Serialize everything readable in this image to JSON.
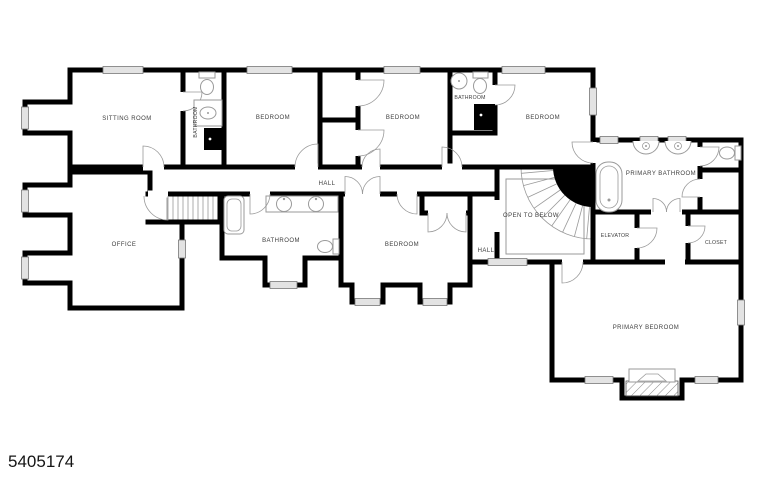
{
  "plan": {
    "id_label": "5405174",
    "type": "second-floor residential floor plan",
    "colors": {
      "wall": "#000000",
      "background": "#ffffff",
      "fixture_line": "#9a9a9a",
      "window_fill": "#e3e3e3",
      "window_stroke": "#777777",
      "label_text": "#3d3d3d",
      "shower_fill": "#000000"
    },
    "rooms": [
      {
        "label": "SITTING ROOM"
      },
      {
        "label": "BATHROOM"
      },
      {
        "label": "BEDROOM"
      },
      {
        "label": "BEDROOM"
      },
      {
        "label": "BATHROOM"
      },
      {
        "label": "BEDROOM"
      },
      {
        "label": "OFFICE"
      },
      {
        "label": "HALL"
      },
      {
        "label": "BATHROOM"
      },
      {
        "label": "BEDROOM"
      },
      {
        "label": "HALL"
      },
      {
        "label": "OPEN TO BELOW"
      },
      {
        "label": "ELEVATOR"
      },
      {
        "label": "PRIMARY BATHROOM"
      },
      {
        "label": "CLOSET"
      },
      {
        "label": "PRIMARY BEDROOM"
      }
    ],
    "fixtures": [
      "toilet-icon",
      "sink-icon",
      "double-vanity-icon",
      "bathtub-icon",
      "freestanding-tub-icon",
      "shower-icon",
      "straight-staircase-icon",
      "curved-staircase-icon",
      "fireplace-icon",
      "door-swing-icon",
      "window-icon"
    ]
  }
}
